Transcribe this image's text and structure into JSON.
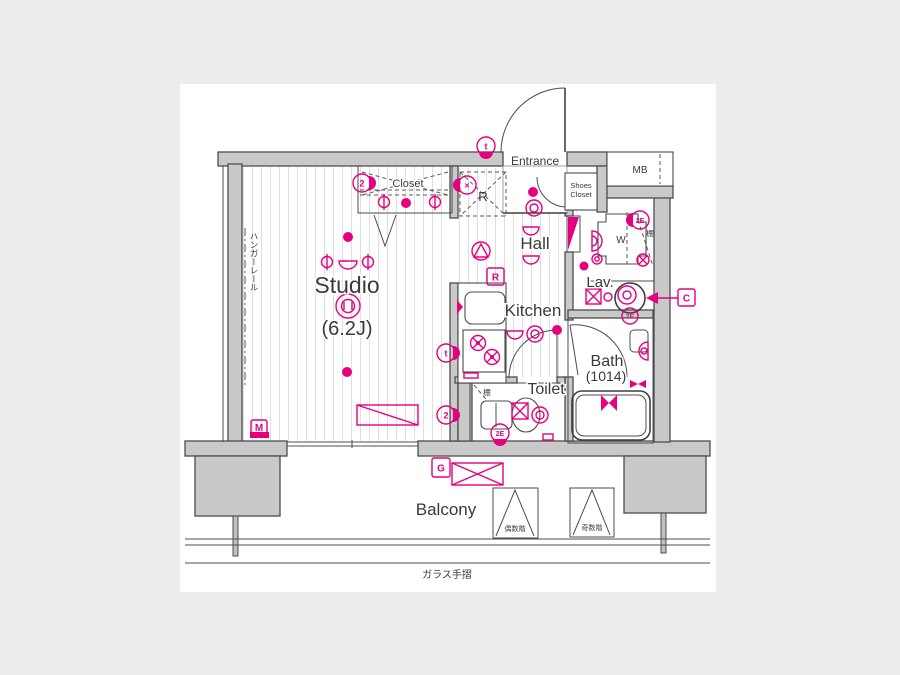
{
  "page": {
    "background": "#ececec",
    "plan_background": "#ffffff"
  },
  "colors": {
    "accent": "#e5007f",
    "wall": "#c9c9c9",
    "outline": "#4c4c4c"
  },
  "rooms": {
    "studio": {
      "name": "Studio",
      "area": "(6.2J)"
    },
    "kitchen": {
      "name": "Kitchen"
    },
    "hall": {
      "name": "Hall"
    },
    "entrance": {
      "name": "Entrance"
    },
    "closet": {
      "name": "Closet"
    },
    "shoes_closet": {
      "line1": "Shoes",
      "line2": "Closet"
    },
    "lavatory": {
      "name": "Lav."
    },
    "bath": {
      "name": "Bath",
      "size": "(1014)"
    },
    "toilet": {
      "name": "Toilet"
    },
    "balcony": {
      "name": "Balcony"
    },
    "meter_box": {
      "name": "MB"
    },
    "washing_machine": {
      "name": "W"
    }
  },
  "annotations": {
    "hanger_rail": "ハンガーレール",
    "glass_handrail": "ガラス手摺",
    "shelf": "棚",
    "even_floors": "偶数階",
    "odd_floors": "奇数階",
    "refrigerator_space": "R"
  },
  "markers": {
    "m": "M",
    "r": "R",
    "c": "C",
    "g": "G",
    "t_entrance": "t",
    "t_kitchen": "t",
    "two_closet": "2",
    "two_studio": "2",
    "x_hall": "×",
    "e_washer": "2E",
    "e_toilet": "2E",
    "e_lav": "2E"
  }
}
